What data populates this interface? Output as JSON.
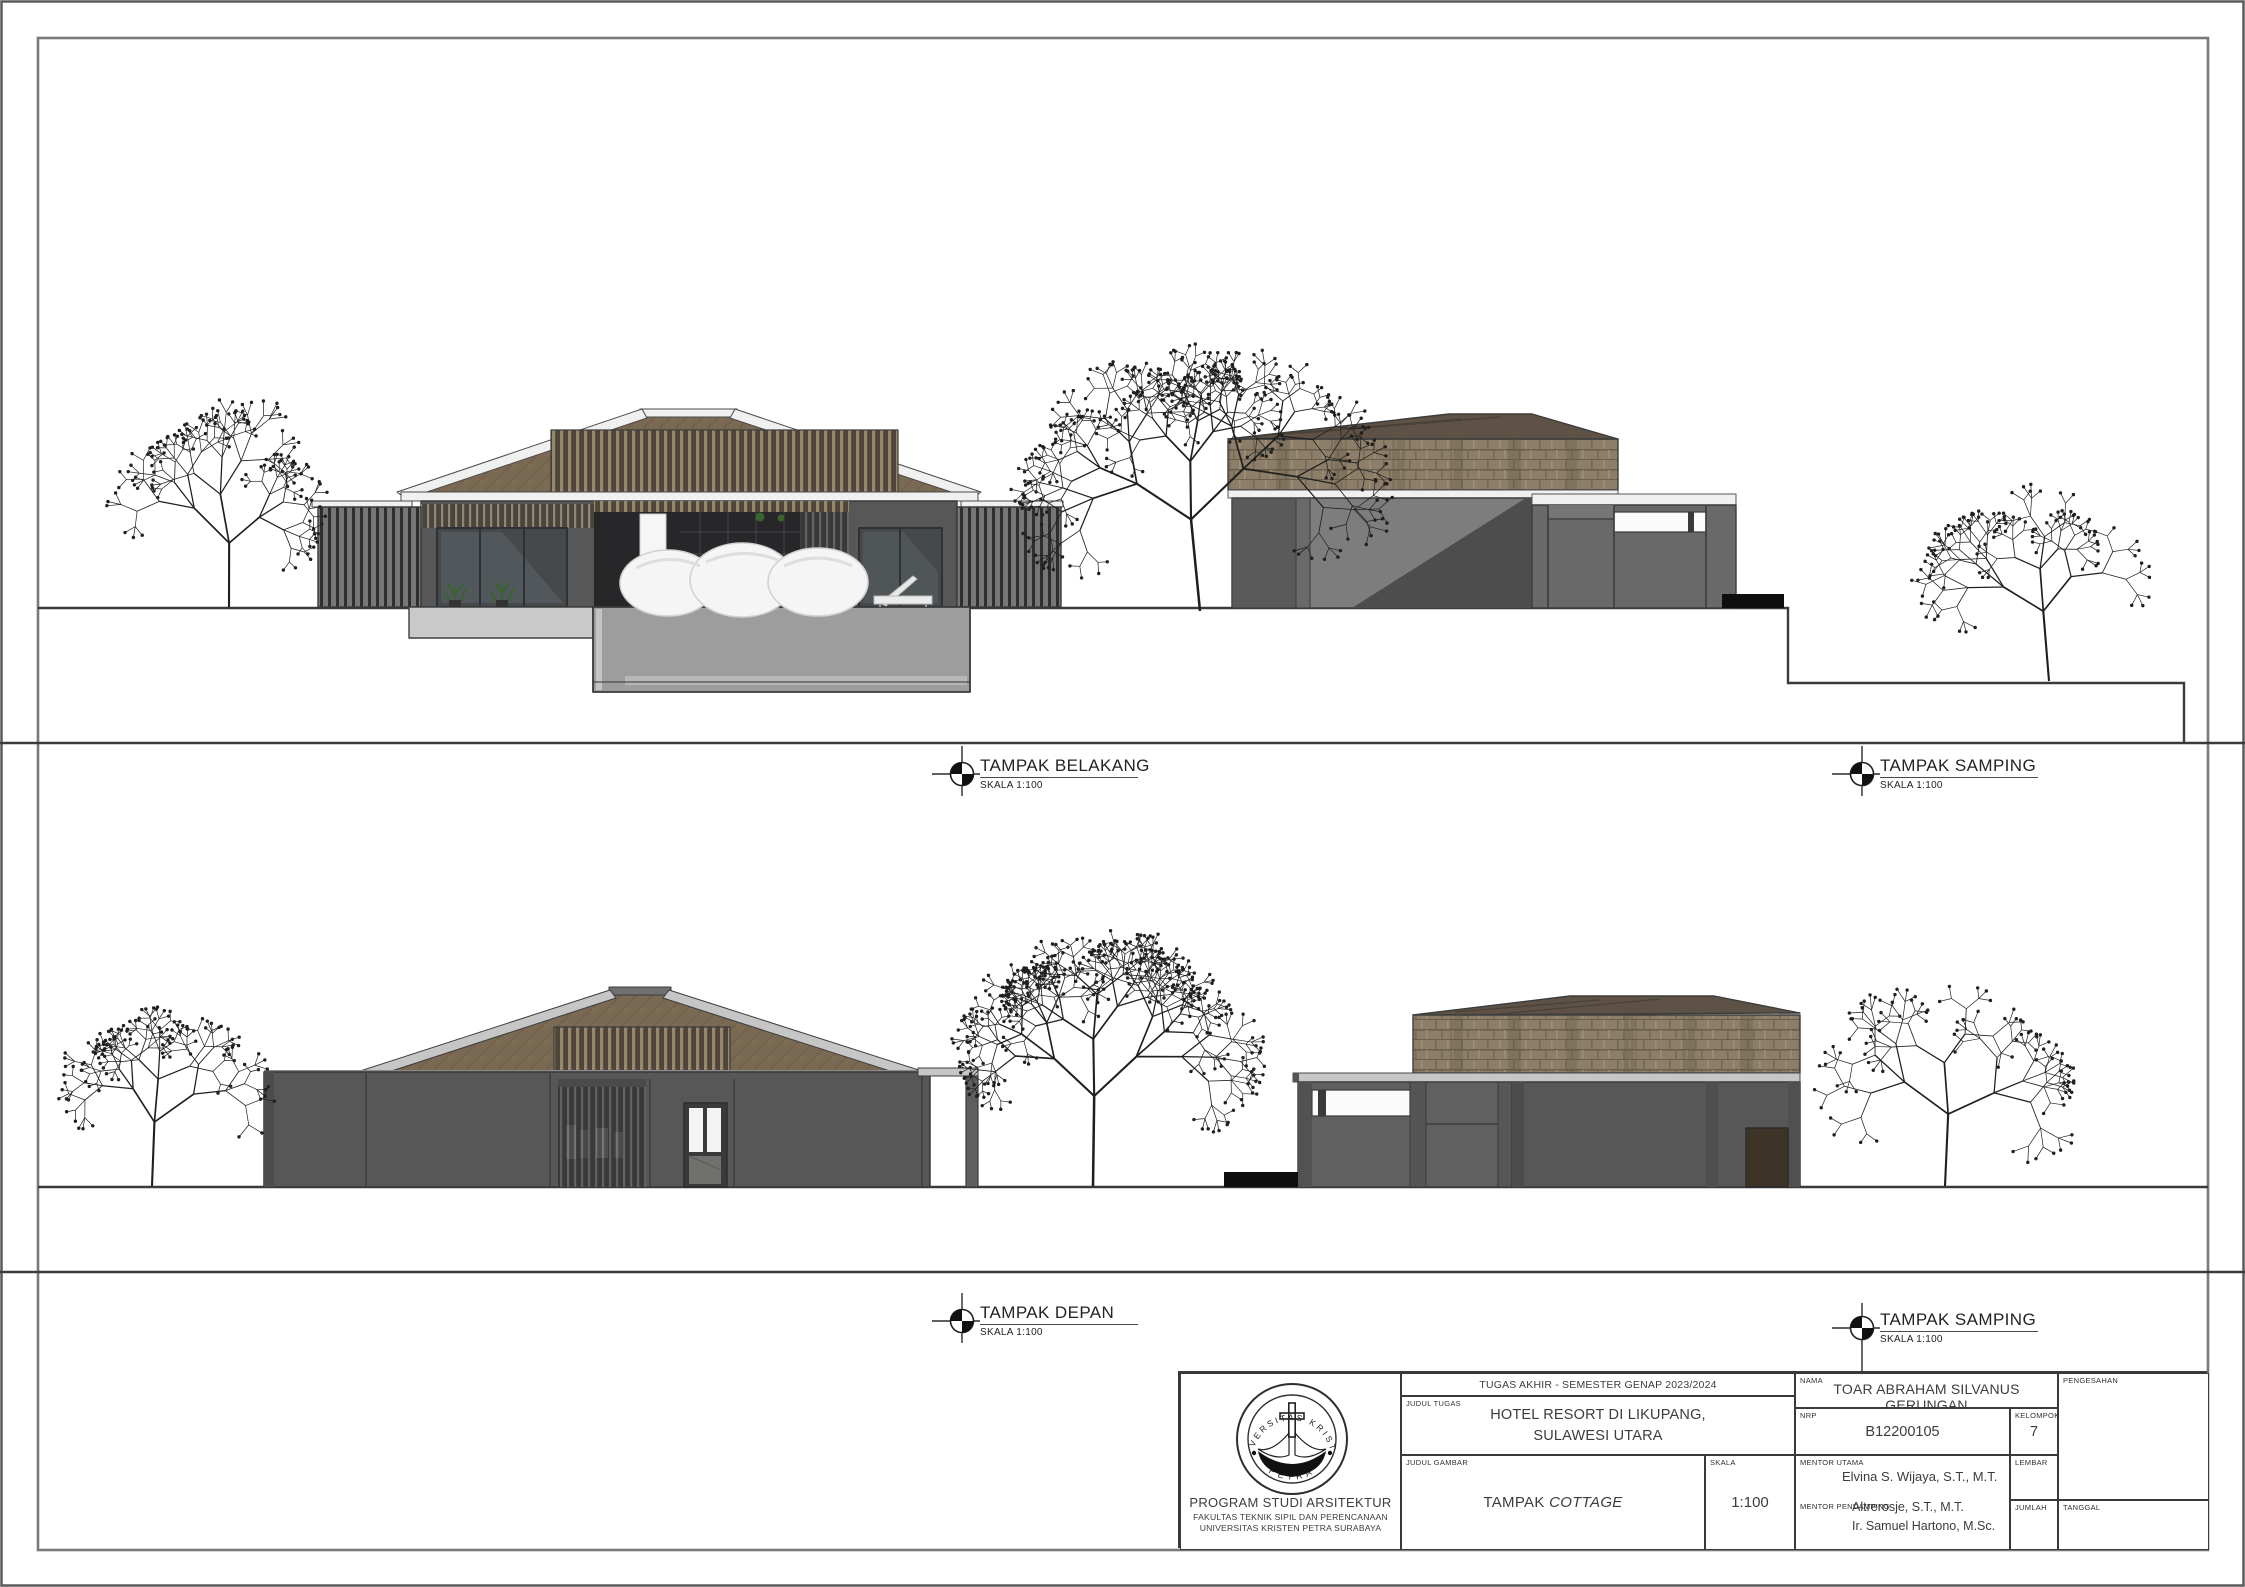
{
  "sheet": {
    "labels": [
      {
        "title": "TAMPAK BELAKANG",
        "scale": "SKALA 1:100"
      },
      {
        "title": "TAMPAK SAMPING",
        "scale": "SKALA 1:100"
      },
      {
        "title": "TAMPAK DEPAN",
        "scale": "SKALA 1:100"
      },
      {
        "title": "TAMPAK SAMPING",
        "scale": "SKALA 1:100"
      }
    ]
  },
  "title_block": {
    "course": "TUGAS AKHIR - SEMESTER GENAP 2023/2024",
    "judul_tugas_label": "JUDUL TUGAS",
    "judul_tugas_line1": "HOTEL RESORT DI LIKUPANG,",
    "judul_tugas_line2": "SULAWESI UTARA",
    "judul_gambar_label": "JUDUL GAMBAR",
    "judul_gambar_prefix": "TAMPAK ",
    "judul_gambar_italic": "COTTAGE",
    "skala_label": "SKALA",
    "skala_value": "1:100",
    "nama_label": "NAMA",
    "nama_value": "TOAR ABRAHAM SILVANUS GERUNGAN",
    "nrp_label": "NRP",
    "nrp_value": "B12200105",
    "kelompok_label": "KELOMPOK",
    "kelompok_value": "7",
    "mentor_utama_label": "MENTOR UTAMA",
    "mentor_utama_value": "Elvina S. Wijaya, S.T., M.T.",
    "mentor_pendamping_label": "MENTOR PENDAMPING",
    "mentor_pendamping_1": "Altrerosje, S.T., M.T.",
    "mentor_pendamping_2": "Ir. Samuel Hartono, M.Sc.",
    "lembar_label": "LEMBAR",
    "jumlah_label": "JUMLAH",
    "pengesahan_label": "PENGESAHAN",
    "tanggal_label": "TANGGAL",
    "institution": {
      "logo_ring_top": "UNIVERSITAS KRISTEN",
      "logo_ring_bottom": "PETRA",
      "line1": "PROGRAM STUDI ARSITEKTUR",
      "line2": "FAKULTAS TEKNIK SIPIL DAN PERENCANAAN",
      "line3": "UNIVERSITAS KRISTEN PETRA SURABAYA"
    }
  },
  "theme": {
    "ink": "#3c3c3c",
    "frame": "#7a7a7a",
    "wall": "#575757",
    "wall-light": "#7d7d7d",
    "wall-shadow": "#4d4d4d",
    "roof-wood": "#7b6a53",
    "roof-dark": "#5d5245",
    "shingle": "#8c7e68",
    "fascia": "#f0f0f0",
    "fascia-gray": "#c6c6c6",
    "podium": "#9d9d9d",
    "slab": "#c9c9c9",
    "glass": "#46494c",
    "interior": "#27272a",
    "cushion": "#f5f5f5",
    "plant": "#39642f",
    "black": "#0e0e0e",
    "tree": "#1f1f1f"
  },
  "scene": {
    "trees": [
      {
        "x": 229,
        "y": 607,
        "len": 64,
        "depth": 5,
        "seed": 11
      },
      {
        "x": 1200,
        "y": 611,
        "len": 92,
        "depth": 6,
        "seed": 7
      },
      {
        "x": 2049,
        "y": 681,
        "len": 70,
        "depth": 5,
        "seed": 23
      },
      {
        "x": 152,
        "y": 1186,
        "len": 64,
        "depth": 5,
        "seed": 5
      },
      {
        "x": 1093,
        "y": 1186,
        "len": 90,
        "depth": 6,
        "seed": 13
      },
      {
        "x": 1945,
        "y": 1186,
        "len": 72,
        "depth": 5,
        "seed": 3
      }
    ]
  }
}
